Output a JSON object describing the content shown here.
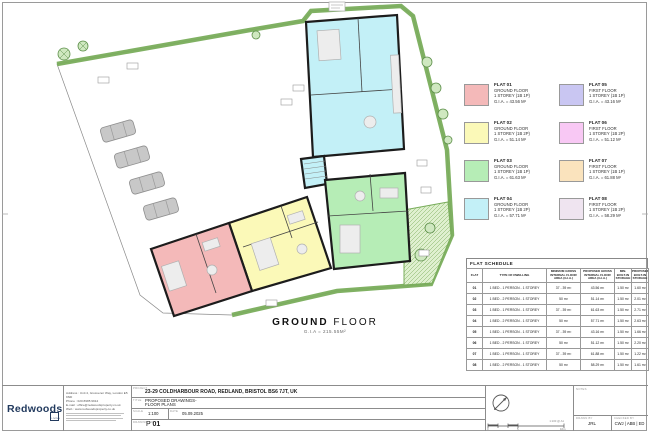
{
  "plan": {
    "title_bold": "GROUND",
    "title_light": " FLOOR",
    "gia": "G.I.A = 215.55M²"
  },
  "legend": {
    "items": [
      {
        "id": "FLAT 01",
        "floor": "GROUND FLOOR",
        "type": "1 STOREY (1B 1P)",
        "gia": "G.I.A. = 43.56 M²",
        "color": "#F4B9B9"
      },
      {
        "id": "FLAT 02",
        "floor": "GROUND FLOOR",
        "type": "1 STOREY (1B 2P)",
        "gia": "G.I.A. = 51.14 M²",
        "color": "#FBF9B8"
      },
      {
        "id": "FLAT 03",
        "floor": "GROUND FLOOR",
        "type": "1 STOREY (1B 1P)",
        "gia": "G.I.A. = 61.63 M²",
        "color": "#B6EDB6"
      },
      {
        "id": "FLAT 04",
        "floor": "GROUND FLOOR",
        "type": "1 STOREY (1B 2P)",
        "gia": "G.I.A. = 57.71 M²",
        "color": "#C3F0F7"
      },
      {
        "id": "FLAT 05",
        "floor": "FIRST FLOOR",
        "type": "1 STOREY (1B 1P)",
        "gia": "G.I.A. = 43.16 M²",
        "color": "#C9C6F2"
      },
      {
        "id": "FLAT 06",
        "floor": "FIRST FLOOR",
        "type": "1 STOREY (1B 2P)",
        "gia": "G.I.A. = 51.12 M²",
        "color": "#F8C8F4"
      },
      {
        "id": "FLAT 07",
        "floor": "FIRST FLOOR",
        "type": "1 STOREY (1B 1P)",
        "gia": "G.I.A. = 61.88 M²",
        "color": "#FAE3BD"
      },
      {
        "id": "FLAT 08",
        "floor": "FIRST FLOOR",
        "type": "1 STOREY (1B 2P)",
        "gia": "G.I.A. = 58.29 M²",
        "color": "#EFE4F0"
      }
    ]
  },
  "schedule": {
    "title": "FLAT SCHEDULE",
    "columns": [
      "FLAT",
      "TYPE OF DWELLING",
      "MINIMUM GROSS INTERNAL FLOOR AREA (G.I.A.)",
      "PROPOSED GROSS INTERNAL FLOOR AREA (G.I.A.)",
      "MIN. BUILT-IN STORAGE",
      "PROPOSED BUILT-IN STORAGE"
    ],
    "rows": [
      [
        "01",
        "1 BED - 1 PERSON - 1 STOREY",
        "37 - 39 m²",
        "43.56 m²",
        "1.50 m²",
        "1.60 m²"
      ],
      [
        "02",
        "1 BED - 2 PERSON - 1 STOREY",
        "50 m²",
        "51.14 m²",
        "1.50 m²",
        "2.01 m²"
      ],
      [
        "03",
        "1 BED - 1 PERSON - 1 STOREY",
        "37 - 39 m²",
        "61.63 m²",
        "1.50 m²",
        "2.71 m²"
      ],
      [
        "04",
        "1 BED - 2 PERSON - 1 STOREY",
        "50 m²",
        "57.71 m²",
        "1.50 m²",
        "2.63 m²"
      ],
      [
        "05",
        "1 BED - 1 PERSON - 1 STOREY",
        "37 - 39 m²",
        "43.16 m²",
        "1.50 m²",
        "1.66 m²"
      ],
      [
        "06",
        "1 BED - 2 PERSON - 1 STOREY",
        "50 m²",
        "51.12 m²",
        "1.50 m²",
        "2.20 m²"
      ],
      [
        "07",
        "1 BED - 1 PERSON - 1 STOREY",
        "37 - 39 m²",
        "61.88 m²",
        "1.50 m²",
        "1.22 m²"
      ],
      [
        "08",
        "1 BED - 2 PERSON - 1 STOREY",
        "50 m²",
        "58.29 m²",
        "1.50 m²",
        "1.61 m²"
      ]
    ]
  },
  "titleblock": {
    "logo": "Redwoods",
    "logo_mark": "LIVING",
    "address": [
      "Address : Unit 4, Grosvenor Way, London E5 9ND",
      "Phone : 020 8985 9912",
      "E-mail : office@redwoodsproperty.co.uk",
      "Web : www.redwoodsproperty.co.uk"
    ],
    "project_label": "PROJECT",
    "project": "23-29 COLDHARBOUR ROAD, REDLAND, BRISTOL BS6 7JT, UK",
    "title_label": "TITLE",
    "title_line1": "PROPOSED DRAWINGS-",
    "title_line2": "FLOOR PLANS",
    "scale_label": "SCALE",
    "scale": "1:100",
    "date_label": "DATE",
    "date": "05.09.2025",
    "number_label": "DRAWING NO.",
    "number_prefix": "P",
    "number": "01",
    "notes_label": "NOTES",
    "drawn_label": "DRAWN BY",
    "drawn": "JRL",
    "checked_label": "CHECKED BY",
    "checked": "CWJ | ABB | ED",
    "scalebar_label": "1:100 @ A1",
    "colors": {
      "brand_navy": "#223A5E",
      "site_green": "#79AD5B",
      "wall": "#1C1C1C"
    }
  }
}
